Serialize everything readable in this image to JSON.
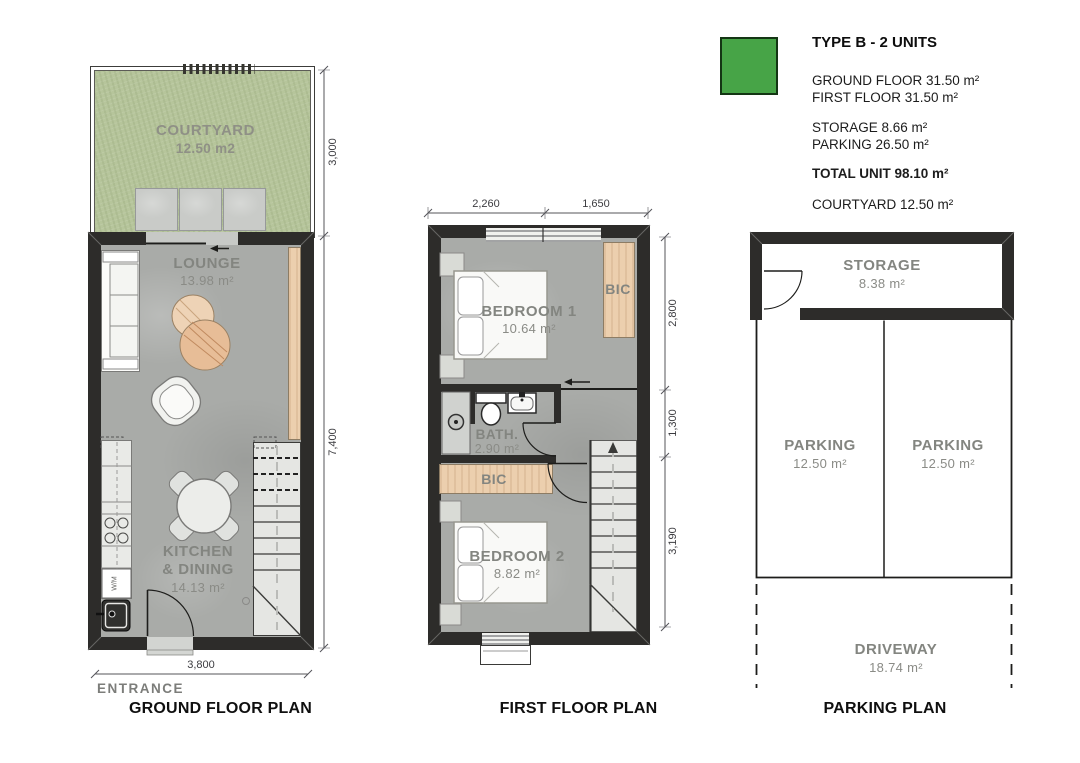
{
  "colors": {
    "legend_green": "#47a447",
    "grass": "#b6c59b",
    "wall": "#2d2c2a",
    "wood": "#eccfae",
    "concrete": "#a9aba8"
  },
  "legend": {
    "title": "TYPE B - 2 UNITS",
    "line_ground": "GROUND FLOOR  31.50 m²",
    "line_first": "FIRST FLOOR 31.50 m²",
    "line_storage": "STORAGE 8.66 m²",
    "line_parking": "PARKING 26.50 m²",
    "line_total": "TOTAL UNIT 98.10 m²",
    "line_courtyard": "COURTYARD 12.50 m²"
  },
  "ground_floor": {
    "title": "GROUND FLOOR PLAN",
    "entrance": "ENTRANCE",
    "courtyard_name": "COURTYARD",
    "courtyard_area": "12.50 m2",
    "lounge_name": "LOUNGE",
    "lounge_area": "13.98 m²",
    "kitchen_name1": "KITCHEN",
    "kitchen_name2": "& DINING",
    "kitchen_area": "14.13 m²",
    "appliance": "W/M",
    "dim_courtyard": "3,000",
    "dim_height": "7,400",
    "dim_width": "3,800"
  },
  "first_floor": {
    "title": "FIRST FLOOR PLAN",
    "bedroom1_name": "BEDROOM 1",
    "bedroom1_area": "10.64 m²",
    "bic_top": "BIC",
    "bath_name": "BATH.",
    "bath_area": "2.90 m²",
    "bic_mid": "BIC",
    "bedroom2_name": "BEDROOM 2",
    "bedroom2_area": "8.82 m²",
    "dim_top_left": "2,260",
    "dim_top_right": "1,650",
    "dim_right_top": "2,800",
    "dim_right_mid": "1,300",
    "dim_right_bottom": "3,190"
  },
  "parking": {
    "title": "PARKING PLAN",
    "storage_name": "STORAGE",
    "storage_area": "8.38 m²",
    "parking_left_name": "PARKING",
    "parking_left_area": "12.50 m²",
    "parking_right_name": "PARKING",
    "parking_right_area": "12.50 m²",
    "driveway_name": "DRIVEWAY",
    "driveway_area": "18.74 m²"
  }
}
